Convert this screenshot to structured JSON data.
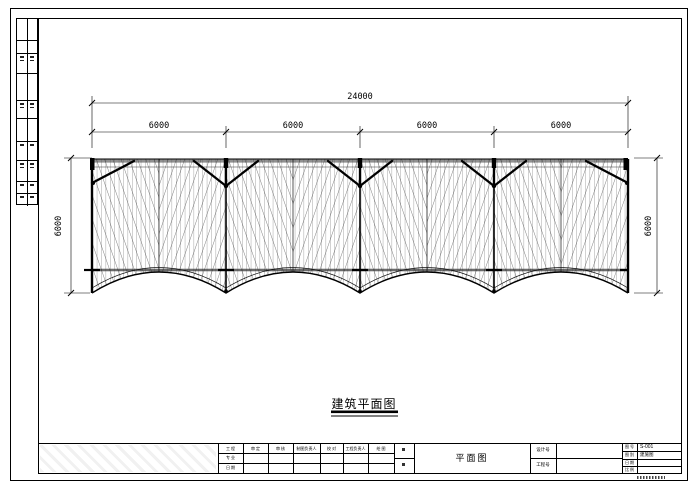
{
  "drawing": {
    "title": "建筑平面图",
    "dims": {
      "overall": "24000",
      "bay1": "6000",
      "bay2": "6000",
      "bay3": "6000",
      "bay4": "6000",
      "height_left": "6000",
      "height_right": "6000"
    },
    "structure": {
      "type": "plan",
      "bays": 4,
      "bay_width_mm": 6000,
      "total_width_mm": 24000,
      "depth_mm": 6000
    }
  },
  "titleblock": {
    "plan_name": "平面图",
    "header": {
      "c1": "工 程",
      "c2": "审 定",
      "c3": "审 核",
      "c4": "制图负责人",
      "c5": "校 对",
      "c6": "工程负责人",
      "c7": "绘 图"
    },
    "c1r2": "专 业",
    "c1r3": "日 期",
    "mid": {
      "r1": "设计号",
      "r2": "工程号"
    },
    "right": {
      "l1": "图 号",
      "v1": "S-001",
      "l2": "图 别",
      "v2": "建施图",
      "l3": "日 期",
      "v3": "",
      "l4": "比 例",
      "v4": ""
    }
  },
  "colors": {
    "line": "#000000",
    "mesh_gray": "#4a4a4a",
    "band_gray": "#909090",
    "paper": "#ffffff"
  }
}
